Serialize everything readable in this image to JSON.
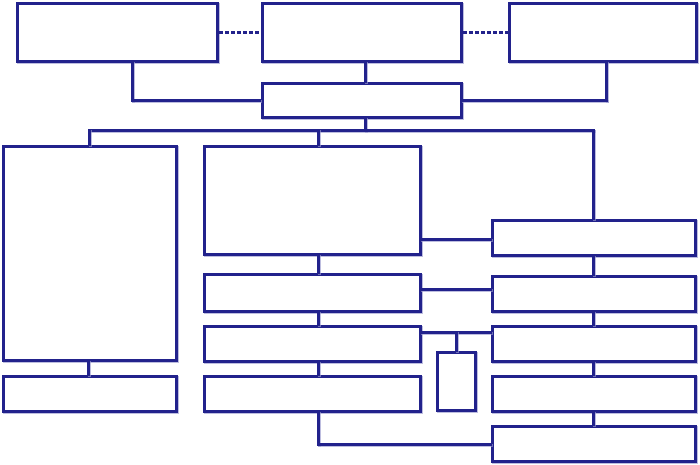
{
  "diagram": {
    "type": "flowchart-template",
    "background_color": "#ffffff",
    "line_color": "#22228c",
    "halo_color": "rgba(154,154,206,0.65)",
    "nodes": [
      {
        "id": "top-left",
        "label": ""
      },
      {
        "id": "top-center",
        "label": ""
      },
      {
        "id": "top-right",
        "label": ""
      },
      {
        "id": "hub",
        "label": ""
      },
      {
        "id": "left-tall",
        "label": ""
      },
      {
        "id": "left-bottom",
        "label": ""
      },
      {
        "id": "mid-1",
        "label": ""
      },
      {
        "id": "mid-2",
        "label": ""
      },
      {
        "id": "mid-3",
        "label": ""
      },
      {
        "id": "mid-4",
        "label": ""
      },
      {
        "id": "right-1",
        "label": ""
      },
      {
        "id": "right-2",
        "label": ""
      },
      {
        "id": "right-3",
        "label": ""
      },
      {
        "id": "right-4",
        "label": ""
      },
      {
        "id": "right-5",
        "label": ""
      },
      {
        "id": "small-vertical",
        "label": ""
      }
    ],
    "edges": [
      {
        "from": "top-left",
        "to": "top-center",
        "style": "dashed"
      },
      {
        "from": "top-center",
        "to": "top-right",
        "style": "dashed"
      },
      {
        "from": "top-left",
        "to": "hub",
        "style": "solid"
      },
      {
        "from": "top-center",
        "to": "hub",
        "style": "solid"
      },
      {
        "from": "top-right",
        "to": "hub",
        "style": "solid"
      },
      {
        "from": "hub",
        "to": "left-tall",
        "style": "solid"
      },
      {
        "from": "hub",
        "to": "mid-1",
        "style": "solid"
      },
      {
        "from": "hub",
        "to": "right-1",
        "style": "solid"
      },
      {
        "from": "left-tall",
        "to": "left-bottom",
        "style": "solid"
      },
      {
        "from": "mid-1",
        "to": "mid-2",
        "style": "solid"
      },
      {
        "from": "mid-2",
        "to": "mid-3",
        "style": "solid"
      },
      {
        "from": "mid-3",
        "to": "mid-4",
        "style": "solid"
      },
      {
        "from": "mid-1",
        "to": "right-1",
        "style": "solid"
      },
      {
        "from": "mid-2",
        "to": "right-2",
        "style": "solid"
      },
      {
        "from": "mid-3",
        "to": "right-3",
        "style": "solid"
      },
      {
        "from": "mid-3",
        "to": "small-vertical",
        "style": "solid"
      },
      {
        "from": "mid-4",
        "to": "right-5",
        "style": "solid"
      },
      {
        "from": "right-1",
        "to": "right-2",
        "style": "solid"
      },
      {
        "from": "right-2",
        "to": "right-3",
        "style": "solid"
      },
      {
        "from": "right-3",
        "to": "right-4",
        "style": "solid"
      },
      {
        "from": "right-4",
        "to": "right-5",
        "style": "solid"
      }
    ]
  }
}
